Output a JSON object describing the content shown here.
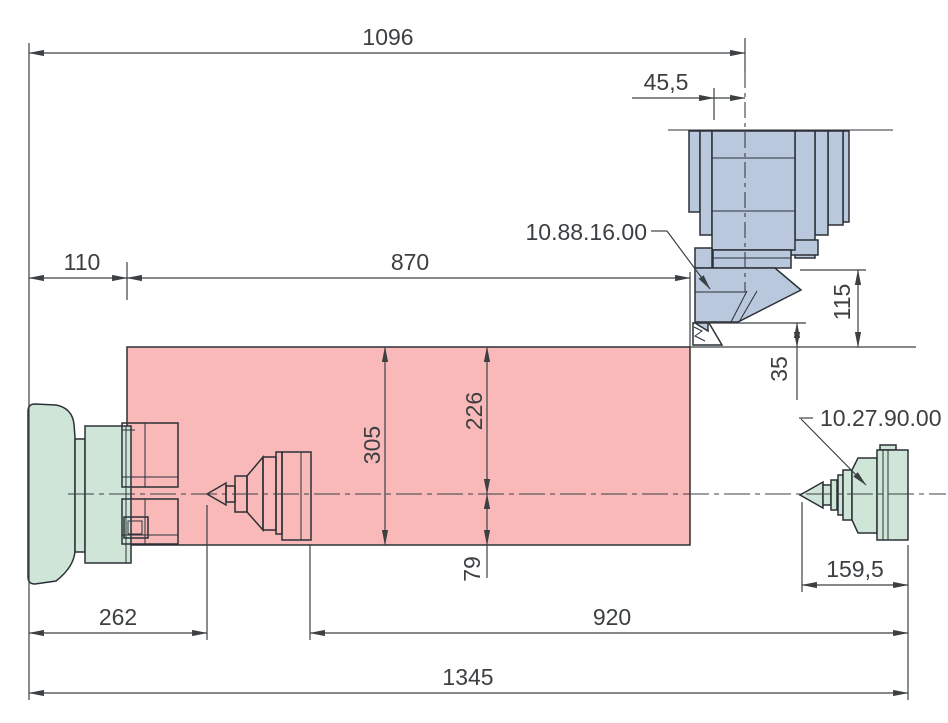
{
  "drawing": {
    "dimensions": {
      "d1096": "1096",
      "d45_5": "45,5",
      "d110": "110",
      "d870": "870",
      "d115": "115",
      "d35": "35",
      "d305": "305",
      "d226": "226",
      "d79": "79",
      "d262": "262",
      "d920": "920",
      "d1345": "1345",
      "d159_5": "159,5"
    },
    "labels": {
      "turret_part": "10.88.16.00",
      "center_part": "10.27.90.00"
    },
    "colors": {
      "work_area": "#f9b9b9",
      "turret": "#b9c8dd",
      "chuck": "#cfe5d8",
      "line": "#3c4043"
    }
  }
}
